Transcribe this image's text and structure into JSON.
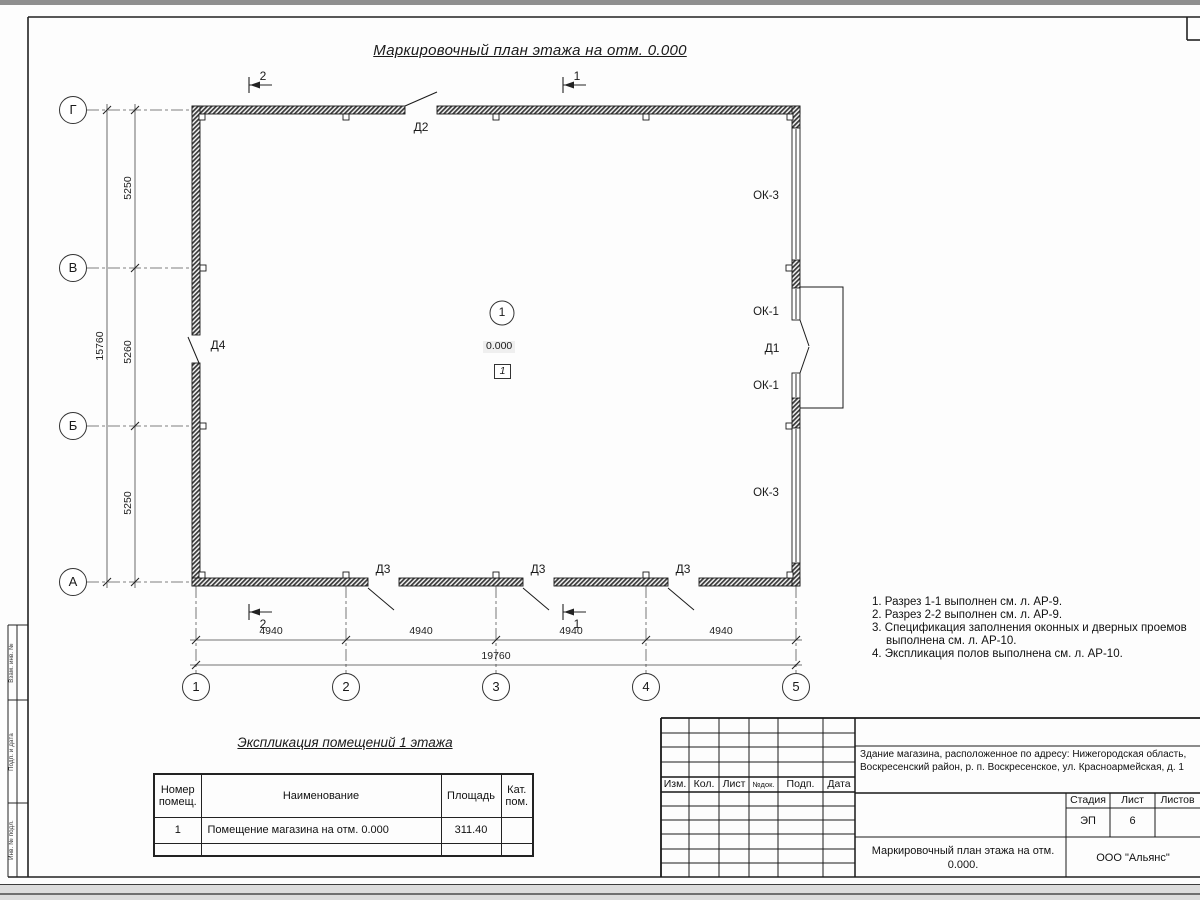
{
  "page": {
    "drawing_title": "Маркировочный план этажа на отм. 0.000"
  },
  "plan": {
    "axis_letters": [
      "Г",
      "В",
      "Б",
      "А"
    ],
    "axis_numbers": [
      "1",
      "2",
      "3",
      "4",
      "5"
    ],
    "dim_left_segments": [
      "5250",
      "5260",
      "5250"
    ],
    "dim_left_total": "15760",
    "dim_bottom_segments": [
      "4940",
      "4940",
      "4940",
      "4940"
    ],
    "dim_bottom_total": "19760",
    "section_top": [
      "2",
      "1"
    ],
    "section_bottom": [
      "2",
      "1"
    ],
    "door_d1": "Д1",
    "door_d2": "Д2",
    "door_d3": "Д3",
    "door_d4": "Д4",
    "window_ok1": "ОК-1",
    "window_ok3": "ОК-3",
    "room_number": "1",
    "room_elevation": "0.000",
    "floor_type": "1"
  },
  "notes": {
    "items": [
      "1. Разрез 1-1 выполнен см. л. АР-9.",
      "2. Разрез 2-2 выполнен см. л. АР-9.",
      "3. Спецификация заполнения оконных и дверных проемов выполнена см. л. АР-10.",
      "4. Экспликация полов выполнена см. л. АР-10."
    ]
  },
  "explication": {
    "title": "Экспликация помещений 1 этажа",
    "headers": {
      "number": "Номер помещ.",
      "name": "Наименование",
      "area": "Площадь",
      "category": "Кат. пом."
    },
    "rows": [
      {
        "number": "1",
        "name": "Помещение магазина на отм. 0.000",
        "area": "311.40",
        "category": ""
      }
    ]
  },
  "titleblock": {
    "columns": [
      "Изм.",
      "Кол.",
      "Лист",
      "№док.",
      "Подп.",
      "Дата"
    ],
    "project": "Здание магазина, расположенное по адресу: Нижегородская область, Воскресенский район, р. п. Воскресенское, ул. Красноармейская, д. 1",
    "stage_label": "Стадия",
    "sheet_label": "Лист",
    "sheets_label": "Листов",
    "stage": "ЭП",
    "sheet": "6",
    "sheets": "",
    "sheet_title": "Маркировочный план этажа на отм. 0.000.",
    "company": "ООО \"Альянс\""
  },
  "margin_stamp": {
    "labels": [
      "Взам. инв. №",
      "Подп. и дата",
      "Инв. № подл."
    ]
  }
}
